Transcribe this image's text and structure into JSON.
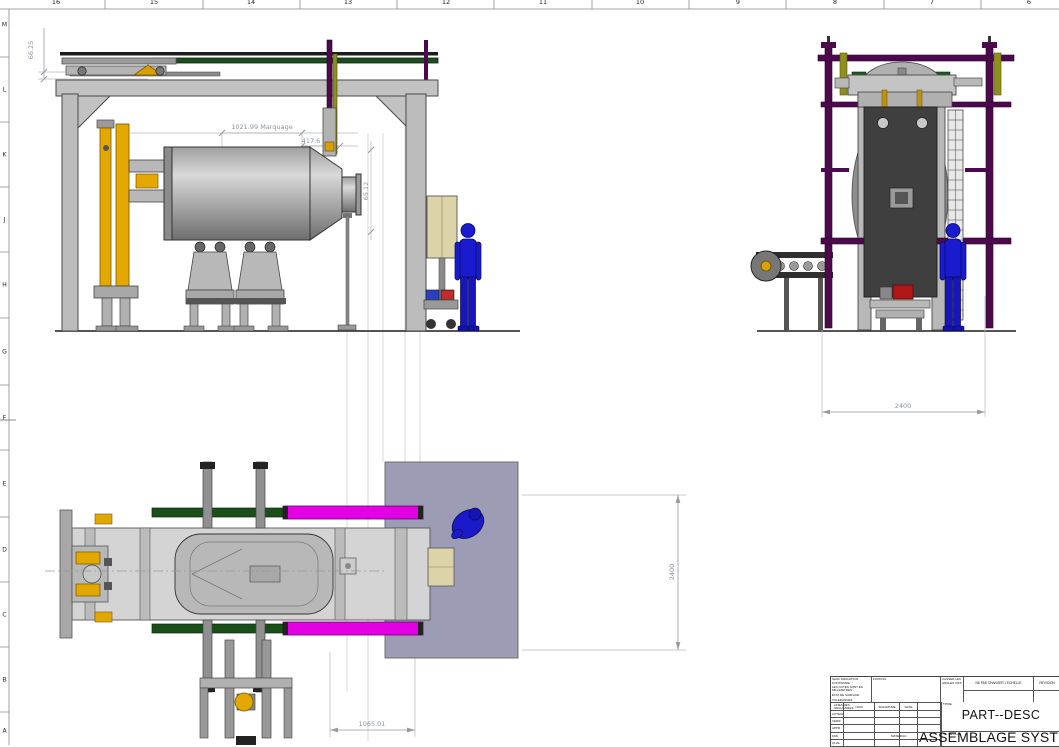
{
  "sheet": {
    "ruler_top": {
      "numbers": [
        "16",
        "15",
        "14",
        "13",
        "12",
        "11",
        "10",
        "9",
        "8",
        "7",
        "6"
      ]
    },
    "ruler_left": {
      "letters": [
        "M",
        "L",
        "K",
        "J",
        "H",
        "G",
        "F",
        "E",
        "D",
        "C",
        "B",
        "A"
      ]
    }
  },
  "dimensions": {
    "d_66_25": "66.25",
    "d_marquage": "1021.99 Marquage",
    "d_417_6": "417.6",
    "d_65_12": "65.12",
    "d_2400_side": "2400",
    "d_2400_plan": "2400",
    "d_1065_01": "1065.01"
  },
  "title_block": {
    "tolerance_note_lines": [
      "SAUF INDICATION CONTRAIRE:",
      "LES COTES SONT EN MILLIMETRES",
      "ETAT DE SURFACE:",
      "TOLERANCES:",
      "LINEAIRES:",
      "ANGULAIRES:"
    ],
    "finish_label": "FINITION:",
    "deburr_note": "CASSER LES ANGLES VIFS",
    "scale_note": "NE PAS CHANGER L'ECHELLE",
    "revision_label": "REVISION",
    "columns": {
      "name": "NOM",
      "signature": "SIGNATURE",
      "date": "DATE"
    },
    "rows": [
      "AUTEUR",
      "VERIF.",
      "APPR.",
      "FAB.",
      "QUAL."
    ],
    "title_label": "TITRE:",
    "title_value": "PART--DESC",
    "material_label": "MATERIAU:",
    "drawing_no_label": "No. DE PLAN",
    "drawing_no_value": "ASSEMBLAGE SYSTEME CO"
  },
  "palette": {
    "magenta_rail": "#e400e4",
    "purple_frame": "#4d094d",
    "safety_yellow": "#d8a000",
    "olive": "#8f8f1f",
    "dark_green_rail": "#1d4d1d",
    "operator_blue": "#1a1ace",
    "plate_gray": "#9c9cb4",
    "cabinet_beige": "#ddd3a8",
    "dim_gray": "#8d93a0"
  }
}
